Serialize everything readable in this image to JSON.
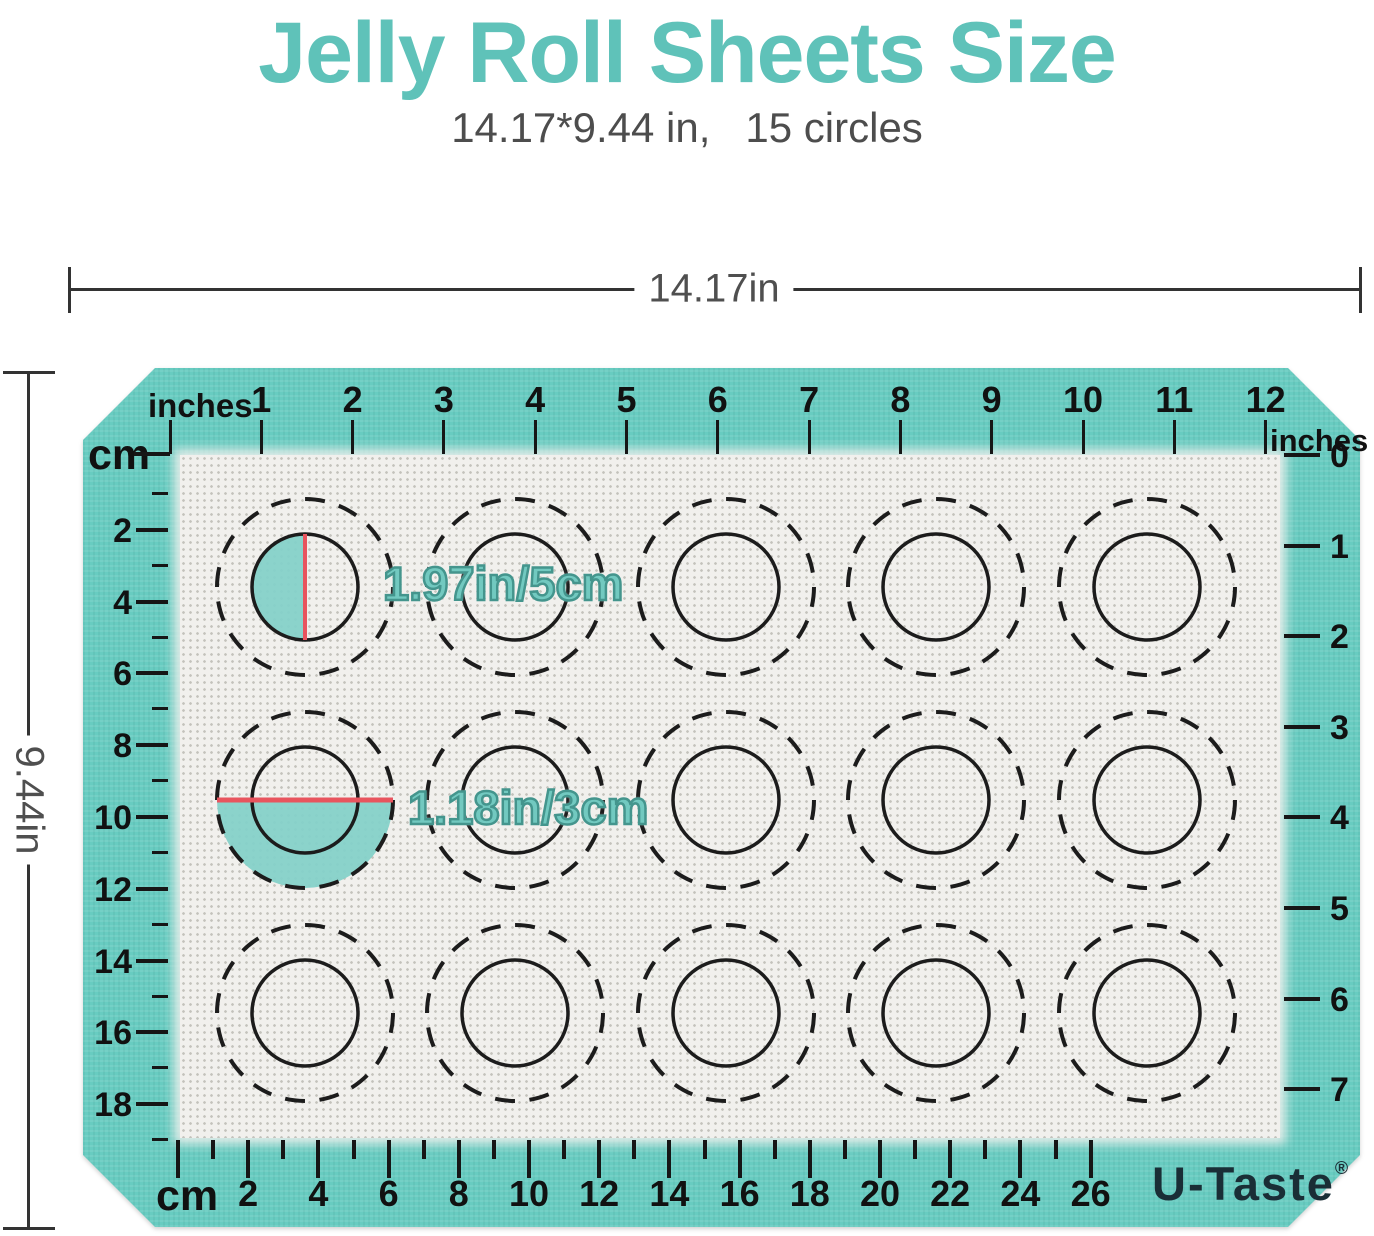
{
  "title": "Jelly Roll Sheets Size",
  "subtitle": "14.17*9.44 in,   15 circles",
  "dimensions": {
    "width_label": "14.17in",
    "height_label": "9.44in"
  },
  "mat": {
    "rulers": {
      "top": {
        "unit": "inches",
        "labels": [
          1,
          2,
          3,
          4,
          5,
          6,
          7,
          8,
          9,
          10,
          11,
          12
        ]
      },
      "left": {
        "unit": "cm",
        "labels": [
          2,
          4,
          6,
          8,
          10,
          12,
          14,
          16,
          18
        ]
      },
      "bottom": {
        "unit": "cm",
        "labels": [
          2,
          4,
          6,
          8,
          10,
          12,
          14,
          16,
          18,
          20,
          22,
          24,
          26
        ]
      },
      "right": {
        "unit": "inches",
        "labels": [
          0,
          1,
          2,
          3,
          4,
          5,
          6,
          7
        ]
      }
    },
    "circles": {
      "rows": 3,
      "cols": 5,
      "count": 15
    },
    "annotations": [
      {
        "text": "1.97in/5cm"
      },
      {
        "text": "1.18in/3cm"
      }
    ],
    "brand": "U-Taste",
    "brand_reg": "®",
    "colors": {
      "mat_teal": "#68CCC1",
      "title_teal": "#5FC2B9",
      "annotation_fill": "#72C9C0",
      "annotation_stroke": "#44958D",
      "highlight_fill": "#85D1C9",
      "red_line": "#E8545E",
      "mark_black": "#161616"
    }
  }
}
